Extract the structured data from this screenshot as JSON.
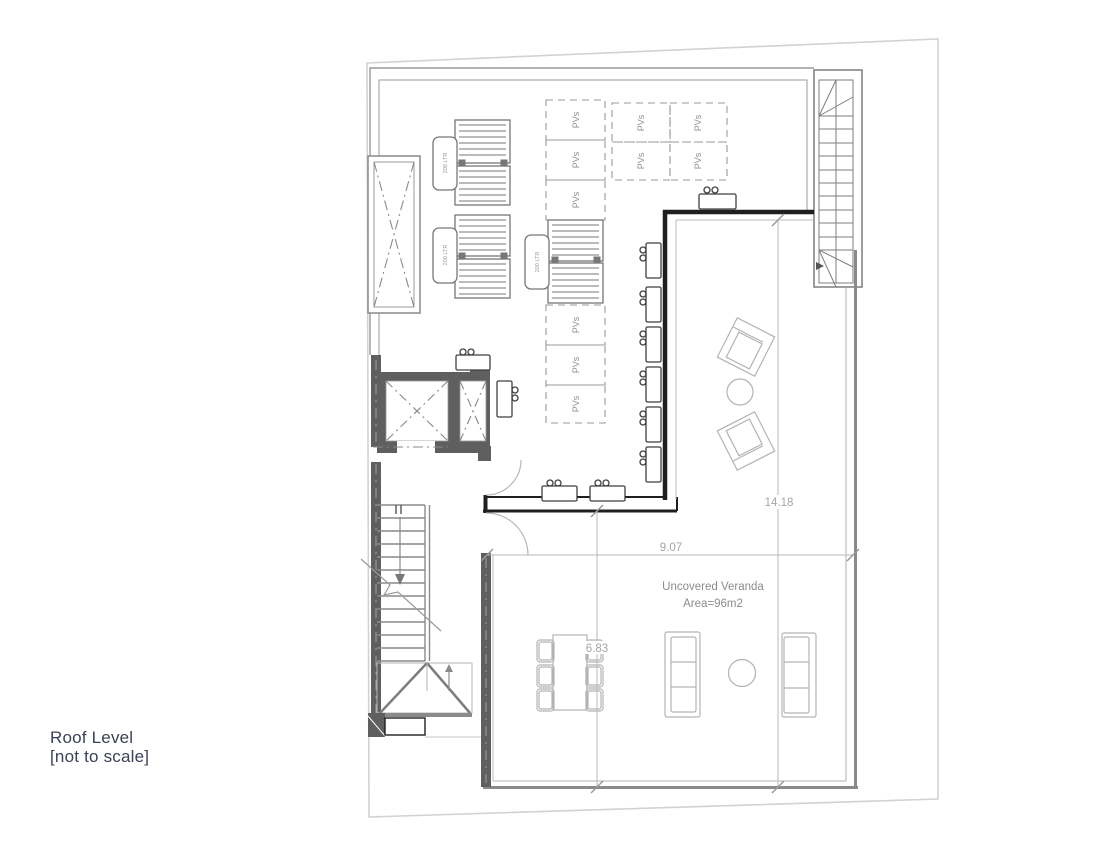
{
  "page": {
    "title_line1": "Roof Level",
    "title_line2": "[not to scale]"
  },
  "plan": {
    "pv_label": "PVs",
    "tank_label": "200 LTR",
    "veranda_label": "Uncovered Veranda",
    "veranda_area": "Area=96m2",
    "dim_height": "14.18",
    "dim_width": "9.07",
    "dim_depth": "6.83"
  },
  "colors": {
    "wall_dark": "#5f5f5f",
    "wall_black": "#1f1f1f",
    "boundary_light": "#d2d2d2",
    "roof_line": "#9a9a9a",
    "dim_line": "#b8b8b8",
    "dim_text": "#a5a5a5",
    "furniture": "#b3b3b3",
    "title_text": "#3c4254"
  }
}
